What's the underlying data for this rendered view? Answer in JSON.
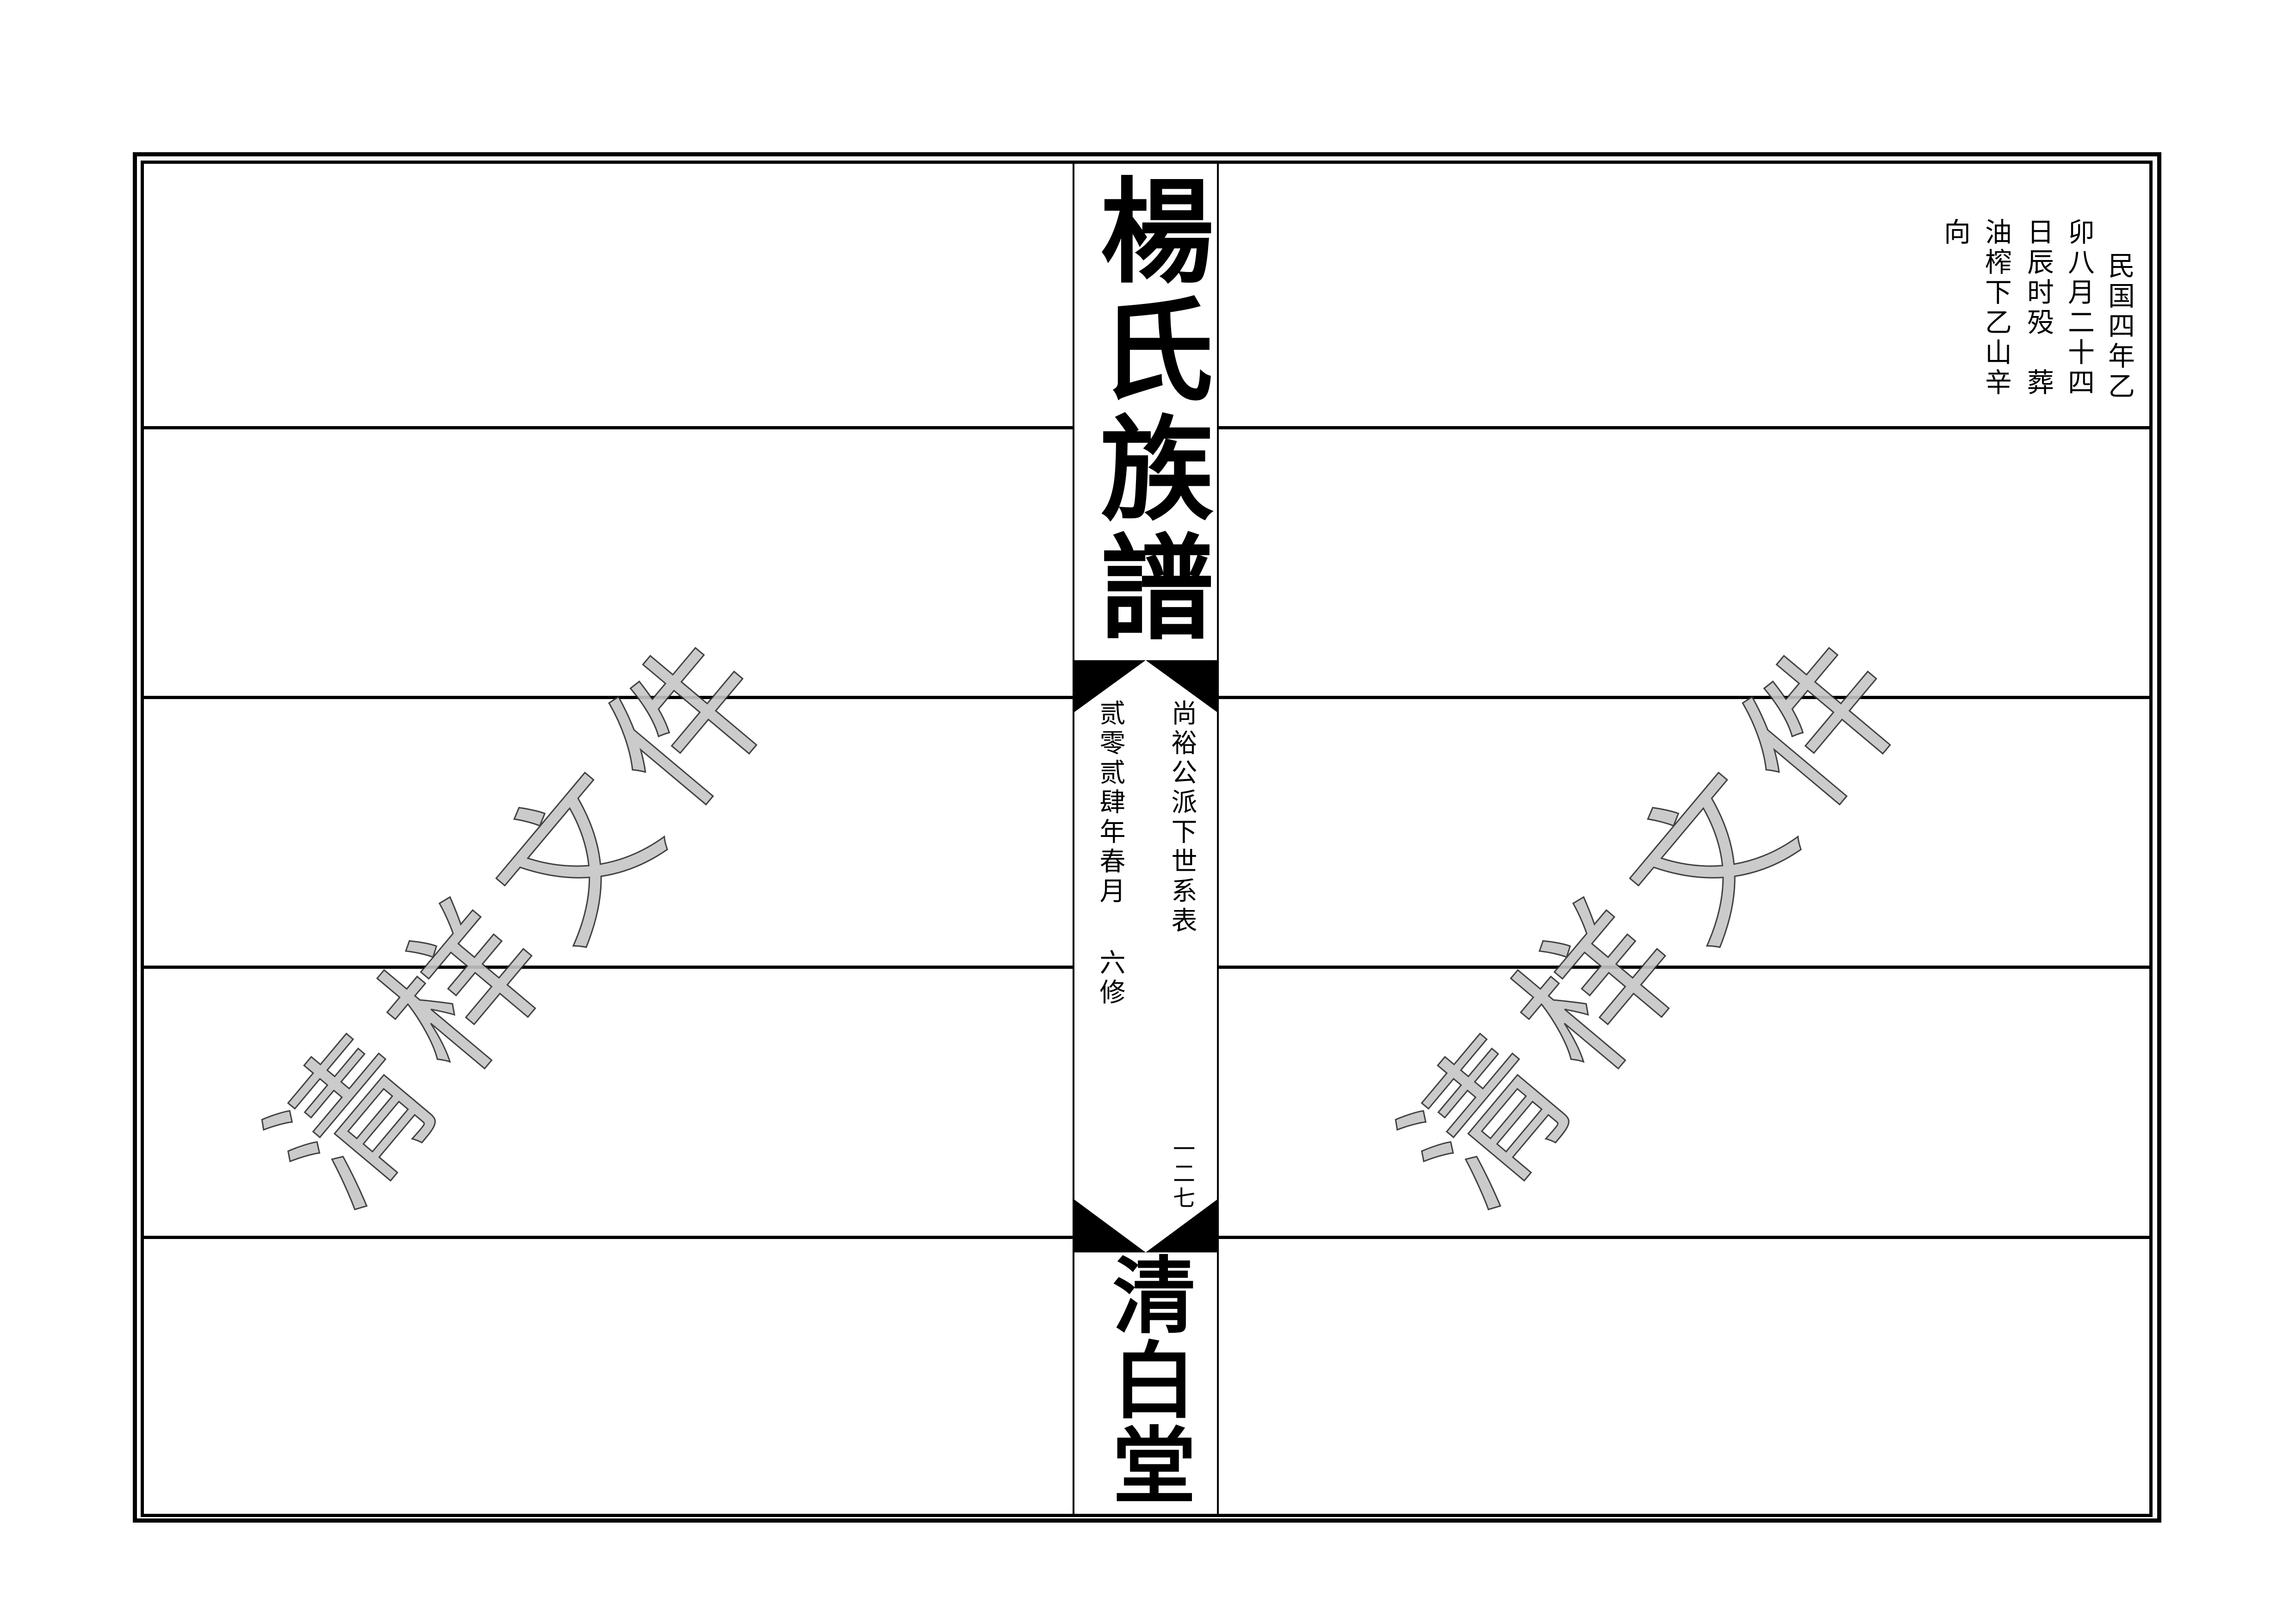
{
  "spine": {
    "title_top": "楊氏族譜",
    "subtitle": "尚裕公派下世系表",
    "edition_year": "贰零贰肆年春月",
    "edition_label": "六修",
    "page_number": "一二七",
    "hall_name": "清白堂"
  },
  "right_page": {
    "record_columns": [
      "民国四年乙",
      "卯八月二十四",
      "日辰时殁　葬",
      "油榨下乙山辛",
      "向"
    ]
  },
  "watermark": {
    "text": "清样文件",
    "fill_color": "#c6c6c6",
    "stroke_color": "#2e2e2e"
  },
  "colors": {
    "ink": "#000000",
    "background": "#ffffff"
  }
}
